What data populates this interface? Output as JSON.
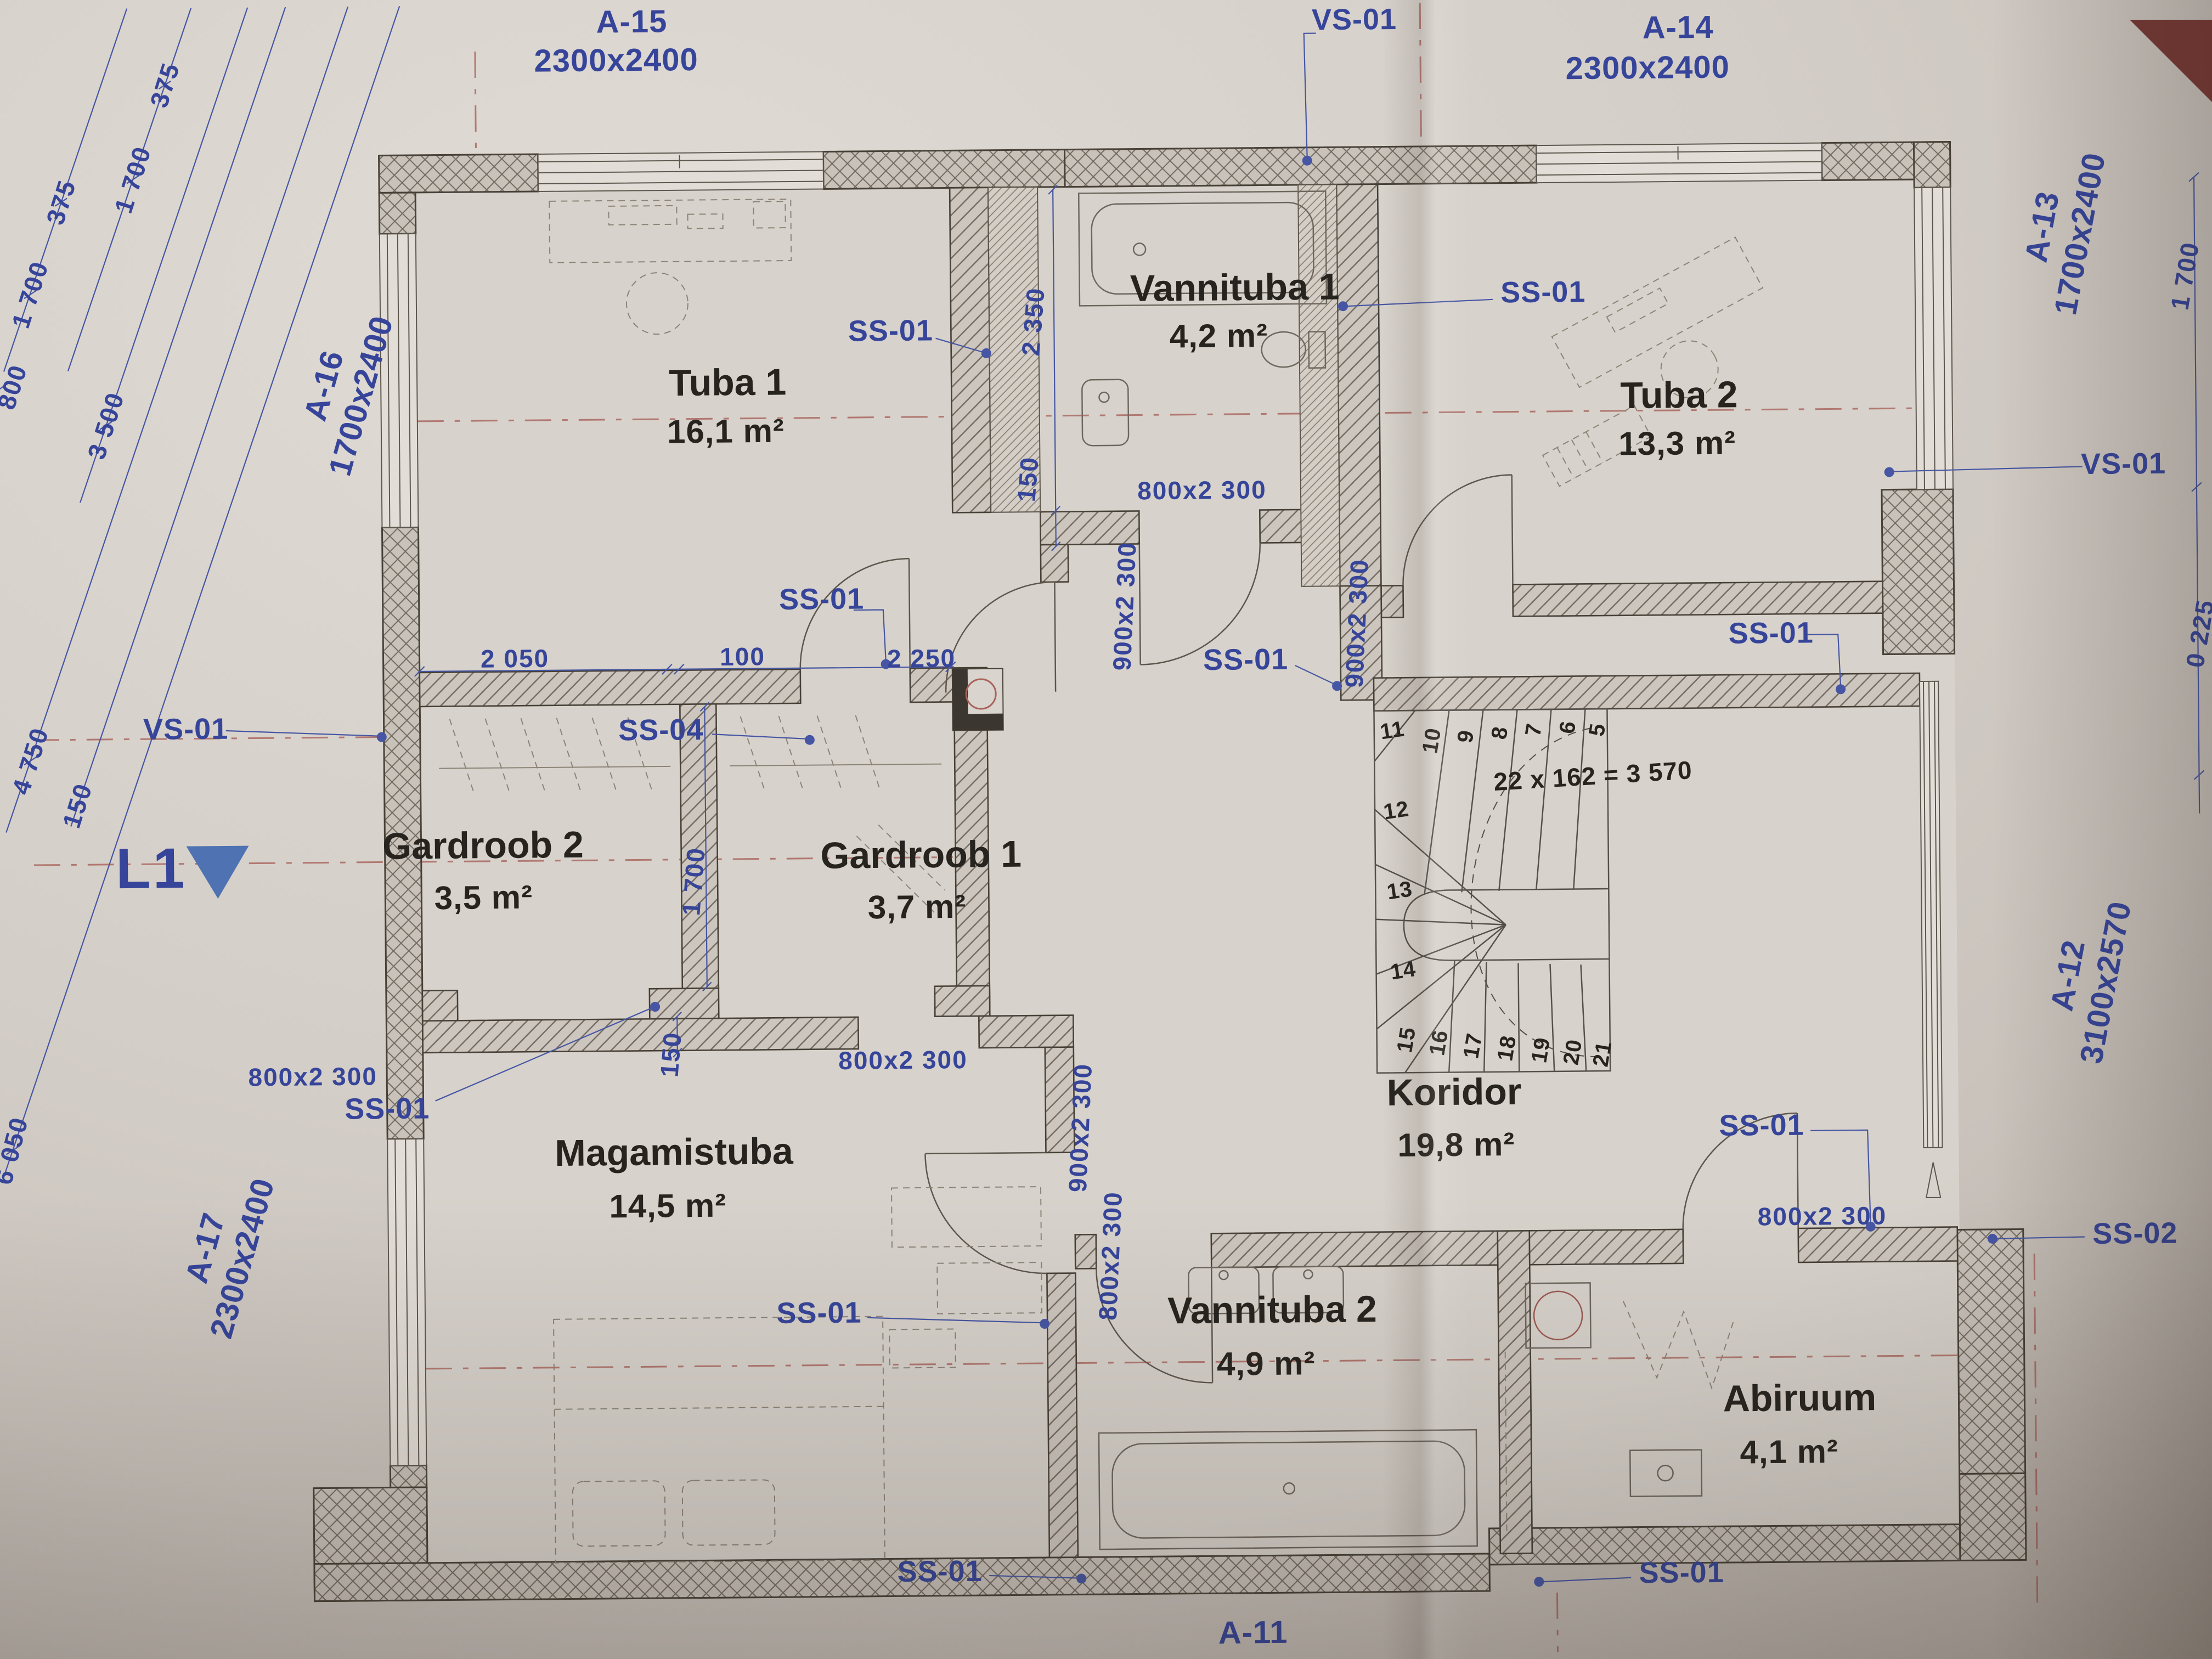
{
  "plan": {
    "marker": {
      "level": "L1"
    },
    "tags": {
      "ss01": "SS-01",
      "ss02": "SS-02",
      "ss04": "SS-04",
      "vs01": "VS-01"
    },
    "windows": {
      "a15": {
        "id": "A-15",
        "size": "2300x2400"
      },
      "a14": {
        "id": "A-14",
        "size": "2300x2400"
      },
      "a16": {
        "id": "A-16",
        "size": "1700x2400"
      },
      "a13": {
        "id": "A-13",
        "size": "1700x2400"
      },
      "a17": {
        "id": "A-17",
        "size": "2300x2400"
      },
      "a12": {
        "id": "A-12",
        "size": "3100x2570"
      },
      "a11": {
        "id": "A-11"
      }
    },
    "doors": {
      "d800": "800x2 300",
      "d900": "900x2 300"
    },
    "rooms": {
      "tuba1": {
        "name": "Tuba 1",
        "area": "16,1 m²"
      },
      "vannituba1": {
        "name": "Vannituba 1",
        "area": "4,2 m²"
      },
      "tuba2": {
        "name": "Tuba 2",
        "area": "13,3 m²"
      },
      "gardroob2": {
        "name": "Gardroob 2",
        "area": "3,5 m²"
      },
      "gardroob1": {
        "name": "Gardroob 1",
        "area": "3,7 m²"
      },
      "magamistuba": {
        "name": "Magamistuba",
        "area": "14,5 m²"
      },
      "vannituba2": {
        "name": "Vannituba 2",
        "area": "4,9 m²"
      },
      "koridor": {
        "name": "Koridor",
        "area": "19,8 m²"
      },
      "abiruum": {
        "name": "Abiruum",
        "area": "4,1 m²"
      }
    },
    "stair": {
      "formula": "22 x 162 = 3 570",
      "steps": [
        "5",
        "6",
        "7",
        "8",
        "9",
        "10",
        "11",
        "12",
        "13",
        "14",
        "15",
        "16",
        "17",
        "18",
        "19",
        "20",
        "21"
      ]
    },
    "dims": {
      "chain": [
        "375",
        "1 700",
        "1 700",
        "375",
        "800",
        "3 500",
        "4 750",
        "150"
      ],
      "edge_left": "6 050",
      "v1": "2 350",
      "v2": "150",
      "top": [
        "2 050",
        "100",
        "2 250"
      ],
      "gardroob": [
        "1 700",
        "150"
      ],
      "right": [
        "1 700",
        "0 225"
      ]
    }
  }
}
